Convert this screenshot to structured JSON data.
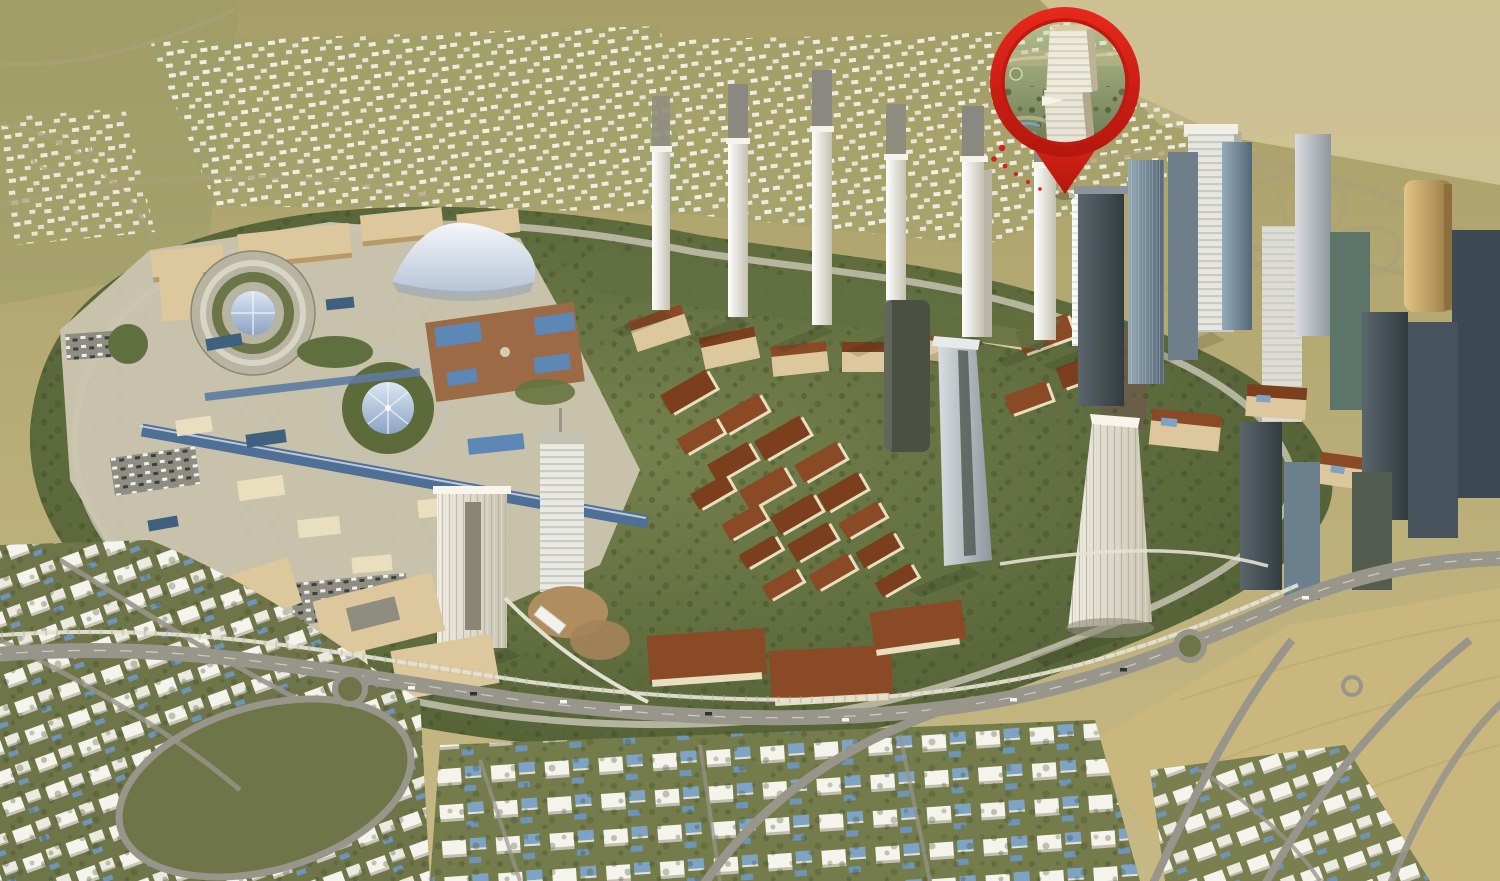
{
  "scene": {
    "description": "3D aerial render of a desert master-planned city district; a red map pin with a tower thumbnail marks a high-rise location",
    "marker": {
      "kind": "location-pin",
      "content": "tower-thumbnail",
      "color": "#d6211a"
    },
    "colors": {
      "desert_top": "#a89e67",
      "desert_bottom": "#c7b984",
      "sand_light": "#d6c89c",
      "sand_field": "#c9b77d",
      "green_base": "#5d6b3a",
      "lawn": "#617040",
      "platform": "#cbc4ae",
      "ring_road": "#c6c2b0",
      "boulevard": "#98958a",
      "monorail": "#e4e1d2",
      "arcade_blue": "#4f6f96",
      "pool_blue": "#5d87b5",
      "pool_dark": "#3f607f",
      "roof_red": "#8a4a26",
      "roof_brown": "#7b3f1e",
      "beige": "#dcc89c",
      "villa_white": "#f2f1ea",
      "villa_roof_blue": "#7fa3c4",
      "tower_white": "#eceadf",
      "tower_steel": "#9aa2a8",
      "tower_dark": "#3c4a55",
      "glass_blue": "#6b7f8c",
      "gold": "#c9a05e",
      "dome_blue": "#8ba3c4",
      "pin_red": "#d6211a"
    }
  }
}
